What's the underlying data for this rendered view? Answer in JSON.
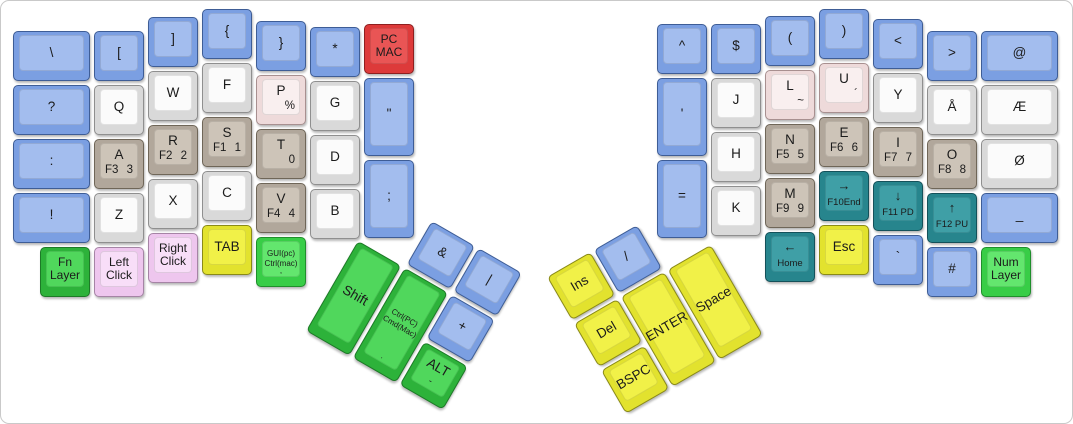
{
  "canvas": {
    "width": 1071,
    "height": 422,
    "background": "#ffffff",
    "border_color": "#c9c9c9"
  },
  "colors": {
    "blue": {
      "side": "#7b9fe2",
      "top": "#a3bdee",
      "edge": "#3e5d96"
    },
    "white": {
      "side": "#d9d9d9",
      "top": "#fbfbfb",
      "edge": "#8f8f8f"
    },
    "tan": {
      "side": "#b1a79b",
      "top": "#cdc4b8",
      "edge": "#6f6658"
    },
    "pink": {
      "side": "#eedada",
      "top": "#f9efef",
      "edge": "#a89090"
    },
    "red": {
      "side": "#dd3a3a",
      "top": "#e95555",
      "edge": "#8f1f1f"
    },
    "green": {
      "side": "#2db23a",
      "top": "#50d75c",
      "edge": "#1d7a27"
    },
    "brightgreen": {
      "side": "#38cd47",
      "top": "#63e66e",
      "edge": "#1f8f2b"
    },
    "lavender": {
      "side": "#eec6ee",
      "top": "#f8def8",
      "edge": "#a584a5"
    },
    "yellow": {
      "side": "#e2e22e",
      "top": "#f1f148",
      "edge": "#8a8a18"
    },
    "teal": {
      "side": "#27858d",
      "top": "#3f9fa6",
      "edge": "#14515a"
    }
  },
  "groups": [
    {
      "name": "left-main-block",
      "x": 0,
      "y": 0,
      "rot": 0,
      "keys": [
        {
          "id": "backslash",
          "x": 12,
          "y": 30,
          "w": 77,
          "c": "blue",
          "main": "\\"
        },
        {
          "id": "question",
          "x": 12,
          "y": 84,
          "w": 77,
          "c": "blue",
          "main": "?"
        },
        {
          "id": "colon",
          "x": 12,
          "y": 138,
          "w": 77,
          "c": "blue",
          "main": ":"
        },
        {
          "id": "exclamation",
          "x": 12,
          "y": 192,
          "w": 77,
          "c": "blue",
          "main": "!"
        },
        {
          "id": "fn-layer",
          "x": 39,
          "y": 246,
          "c": "green",
          "main": "Fn\nLayer",
          "variant": "two-line"
        },
        {
          "id": "bracket-open",
          "x": 93,
          "y": 30,
          "c": "blue",
          "main": "["
        },
        {
          "id": "q",
          "x": 93,
          "y": 84,
          "c": "white",
          "main": "Q"
        },
        {
          "id": "a",
          "x": 93,
          "y": 138,
          "c": "tan",
          "main": "A",
          "bl": "F3",
          "br": "3"
        },
        {
          "id": "z",
          "x": 93,
          "y": 192,
          "c": "white",
          "main": "Z"
        },
        {
          "id": "left-click",
          "x": 93,
          "y": 246,
          "c": "lavender",
          "main": "Left\nClick",
          "variant": "two-line"
        },
        {
          "id": "bracket-close",
          "x": 147,
          "y": 16,
          "c": "blue",
          "main": "]"
        },
        {
          "id": "w",
          "x": 147,
          "y": 70,
          "c": "white",
          "main": "W"
        },
        {
          "id": "r",
          "x": 147,
          "y": 124,
          "c": "tan",
          "main": "R",
          "bl": "F2",
          "br": "2"
        },
        {
          "id": "x",
          "x": 147,
          "y": 178,
          "c": "white",
          "main": "X"
        },
        {
          "id": "right-click",
          "x": 147,
          "y": 232,
          "c": "lavender",
          "main": "Right\nClick",
          "variant": "two-line"
        },
        {
          "id": "brace-open",
          "x": 201,
          "y": 8,
          "c": "blue",
          "main": "{"
        },
        {
          "id": "f",
          "x": 201,
          "y": 62,
          "c": "white",
          "main": "F"
        },
        {
          "id": "s",
          "x": 201,
          "y": 116,
          "c": "tan",
          "main": "S",
          "bl": "F1",
          "br": "1"
        },
        {
          "id": "c",
          "x": 201,
          "y": 170,
          "c": "white",
          "main": "C"
        },
        {
          "id": "tab",
          "x": 201,
          "y": 224,
          "c": "yellow",
          "main": "TAB"
        },
        {
          "id": "brace-close",
          "x": 255,
          "y": 20,
          "c": "blue",
          "main": "}"
        },
        {
          "id": "p",
          "x": 255,
          "y": 74,
          "c": "pink",
          "main": "P",
          "br": "%"
        },
        {
          "id": "t",
          "x": 255,
          "y": 128,
          "c": "tan",
          "main": "T",
          "br": "0"
        },
        {
          "id": "v",
          "x": 255,
          "y": 182,
          "c": "tan",
          "main": "V",
          "bl": "F4",
          "br": "4"
        },
        {
          "id": "gui-ctrl",
          "x": 255,
          "y": 236,
          "c": "brightgreen",
          "main": "GUI(pc)\nCtrl(mac)",
          "tiny": ",",
          "variant": "tiny-two-line"
        },
        {
          "id": "asterisk",
          "x": 309,
          "y": 26,
          "c": "blue",
          "main": "*"
        },
        {
          "id": "g",
          "x": 309,
          "y": 80,
          "c": "white",
          "main": "G"
        },
        {
          "id": "d",
          "x": 309,
          "y": 134,
          "c": "white",
          "main": "D"
        },
        {
          "id": "b",
          "x": 309,
          "y": 188,
          "c": "white",
          "main": "B"
        },
        {
          "id": "pc-mac",
          "x": 363,
          "y": 23,
          "c": "red",
          "main": "PC\nMAC",
          "variant": "two-line"
        },
        {
          "id": "double-quote",
          "x": 363,
          "y": 77,
          "h": 78,
          "c": "blue",
          "main": "\""
        },
        {
          "id": "semicolon",
          "x": 363,
          "y": 159,
          "h": 78,
          "c": "blue",
          "main": ";"
        }
      ]
    },
    {
      "name": "left-thumb-cluster",
      "x": 384,
      "y": 193,
      "rot": 30,
      "keys": [
        {
          "id": "shift",
          "x": 0,
          "y": 54,
          "h": 104,
          "c": "green",
          "main": "Shift"
        },
        {
          "id": "ctrl-cmd",
          "x": 54,
          "y": 54,
          "h": 104,
          "c": "green",
          "main": "Ctrl(PC)\nCmd(Mac)",
          "tiny": ".",
          "variant": "tiny-two-line"
        },
        {
          "id": "ampersand",
          "x": 54,
          "y": 0,
          "c": "blue",
          "main": "&"
        },
        {
          "id": "pipe",
          "x": 108,
          "y": 0,
          "c": "blue",
          "main": "|"
        },
        {
          "id": "plus",
          "x": 108,
          "y": 54,
          "c": "blue",
          "main": "+"
        },
        {
          "id": "alt",
          "x": 108,
          "y": 108,
          "c": "green",
          "main": "ALT",
          "sub": "-"
        }
      ]
    },
    {
      "name": "right-main-block",
      "x": 0,
      "y": 0,
      "rot": 0,
      "keys": [
        {
          "id": "caret",
          "x": 656,
          "y": 23,
          "c": "blue",
          "main": "^"
        },
        {
          "id": "apostrophe",
          "x": 656,
          "y": 77,
          "h": 78,
          "c": "blue",
          "main": "'"
        },
        {
          "id": "equals",
          "x": 656,
          "y": 159,
          "h": 78,
          "c": "blue",
          "main": "="
        },
        {
          "id": "dollar",
          "x": 710,
          "y": 23,
          "c": "blue",
          "main": "$"
        },
        {
          "id": "j",
          "x": 710,
          "y": 77,
          "c": "white",
          "main": "J"
        },
        {
          "id": "h",
          "x": 710,
          "y": 131,
          "c": "white",
          "main": "H"
        },
        {
          "id": "k",
          "x": 710,
          "y": 185,
          "c": "white",
          "main": "K"
        },
        {
          "id": "paren-open",
          "x": 764,
          "y": 15,
          "c": "blue",
          "main": "("
        },
        {
          "id": "l",
          "x": 764,
          "y": 69,
          "c": "pink",
          "main": "L",
          "br": "~"
        },
        {
          "id": "n",
          "x": 764,
          "y": 123,
          "c": "tan",
          "main": "N",
          "bl": "F5",
          "br": "5"
        },
        {
          "id": "m",
          "x": 764,
          "y": 177,
          "c": "tan",
          "main": "M",
          "bl": "F9",
          "br": "9"
        },
        {
          "id": "home",
          "x": 764,
          "y": 231,
          "c": "teal",
          "main": "←",
          "sub": "Home",
          "variant": "arrow"
        },
        {
          "id": "paren-close",
          "x": 818,
          "y": 8,
          "c": "blue",
          "main": ")"
        },
        {
          "id": "u",
          "x": 818,
          "y": 62,
          "c": "pink",
          "main": "U",
          "br": "´"
        },
        {
          "id": "e",
          "x": 818,
          "y": 116,
          "c": "tan",
          "main": "E",
          "bl": "F6",
          "br": "6"
        },
        {
          "id": "f10-end",
          "x": 818,
          "y": 170,
          "c": "teal",
          "main": "→",
          "sub": "F10End",
          "variant": "arrow"
        },
        {
          "id": "esc",
          "x": 818,
          "y": 224,
          "c": "yellow",
          "main": "Esc"
        },
        {
          "id": "less-than",
          "x": 872,
          "y": 18,
          "c": "blue",
          "main": "<"
        },
        {
          "id": "y",
          "x": 872,
          "y": 72,
          "c": "white",
          "main": "Y"
        },
        {
          "id": "i",
          "x": 872,
          "y": 126,
          "c": "tan",
          "main": "I",
          "bl": "F7",
          "br": "7"
        },
        {
          "id": "f11-pd",
          "x": 872,
          "y": 180,
          "c": "teal",
          "main": "↓",
          "sub": "F11 PD",
          "variant": "arrow"
        },
        {
          "id": "backtick",
          "x": 872,
          "y": 234,
          "c": "blue",
          "main": "`"
        },
        {
          "id": "greater-than",
          "x": 926,
          "y": 30,
          "c": "blue",
          "main": ">"
        },
        {
          "id": "a-ring",
          "x": 926,
          "y": 84,
          "c": "white",
          "main": "Å"
        },
        {
          "id": "o",
          "x": 926,
          "y": 138,
          "c": "tan",
          "main": "O",
          "bl": "F8",
          "br": "8"
        },
        {
          "id": "f12-pu",
          "x": 926,
          "y": 192,
          "c": "teal",
          "main": "↑",
          "sub": "F12 PU",
          "variant": "arrow"
        },
        {
          "id": "hash",
          "x": 926,
          "y": 246,
          "c": "blue",
          "main": "#"
        },
        {
          "id": "at",
          "x": 980,
          "y": 30,
          "w": 77,
          "c": "blue",
          "main": "@"
        },
        {
          "id": "ae",
          "x": 980,
          "y": 84,
          "w": 77,
          "c": "white",
          "main": "Æ"
        },
        {
          "id": "o-slash",
          "x": 980,
          "y": 138,
          "w": 77,
          "c": "white",
          "main": "Ø"
        },
        {
          "id": "underscore",
          "x": 980,
          "y": 192,
          "w": 77,
          "c": "blue",
          "main": "_"
        },
        {
          "id": "num-layer",
          "x": 980,
          "y": 246,
          "c": "brightgreen",
          "main": "Num\nLayer",
          "variant": "two-line"
        }
      ]
    },
    {
      "name": "right-thumb-cluster",
      "x": 546,
      "y": 276,
      "rot": -30,
      "keys": [
        {
          "id": "ins",
          "x": 0,
          "y": 0,
          "c": "yellow",
          "main": "Ins"
        },
        {
          "id": "del",
          "x": 0,
          "y": 54,
          "c": "yellow",
          "main": "Del"
        },
        {
          "id": "bspc",
          "x": 0,
          "y": 108,
          "c": "yellow",
          "main": "BSPC"
        },
        {
          "id": "slash",
          "x": 54,
          "y": 0,
          "c": "blue",
          "main": "/"
        },
        {
          "id": "enter",
          "x": 54,
          "y": 54,
          "h": 104,
          "c": "yellow",
          "main": "ENTER"
        },
        {
          "id": "space",
          "x": 108,
          "y": 54,
          "h": 104,
          "c": "yellow",
          "main": "Space"
        }
      ]
    }
  ]
}
